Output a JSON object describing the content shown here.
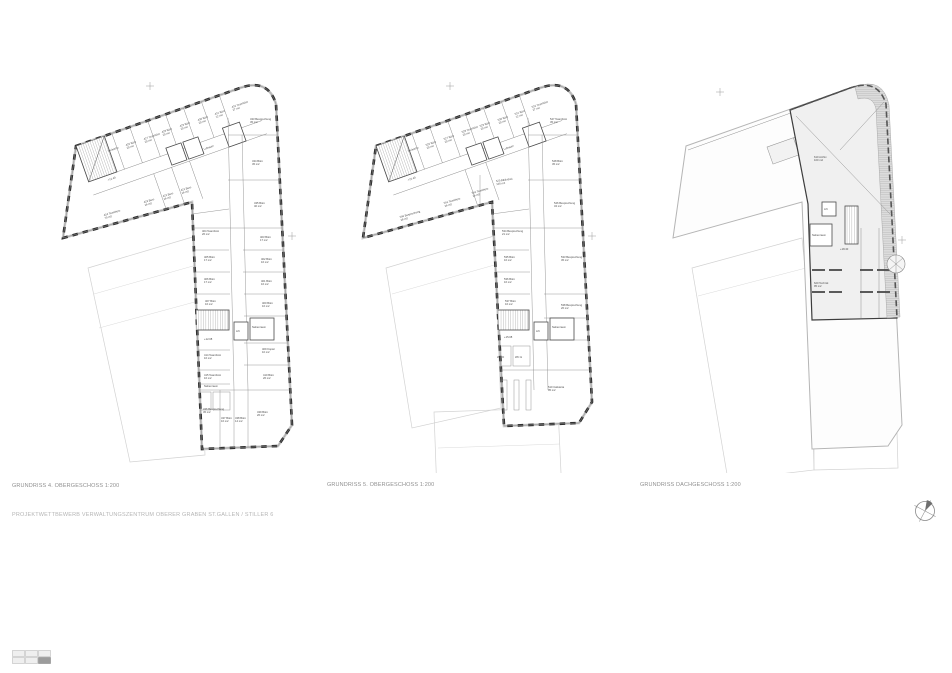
{
  "sheet": {
    "title": "PROJEKTWETTBEWERB VERWALTUNGSZENTRUM OBERER GRABEN ST.GALLEN / STILLER 6"
  },
  "colors": {
    "wall": "#303030",
    "partition": "#8c8c8c",
    "neighbor_outline": "#d2d2d2",
    "roof_hatch": "#9b9b9b",
    "caption": "#8f8f8f",
    "title": "#b5b5b5"
  },
  "footer": {
    "sheet_index": {
      "rows": 2,
      "cols": 3,
      "active_cell": "bottom-right"
    }
  },
  "north_symbol": "north-arrow",
  "plans": [
    {
      "caption": "GRUNDRISS 4. OBERGESCHOSS 1:200",
      "rooms": [
        {
          "name": "Teeküche",
          "area": ""
        },
        {
          "name": "426 Büro",
          "area": "20 m2"
        },
        {
          "name": "427 Teambüro",
          "area": "20 m2"
        },
        {
          "name": "428 Büro",
          "area": "20 m2"
        },
        {
          "name": "429 Büro",
          "area": "20 m2"
        },
        {
          "name": "430 Büro",
          "area": "20 m2"
        },
        {
          "name": "431 Büro",
          "area": "12 m2"
        },
        {
          "name": "432 Teambüro",
          "area": "27 m2"
        },
        {
          "name": "424 Teambüro",
          "area": "70 m2"
        },
        {
          "name": "423 Büro",
          "area": "16 m2"
        },
        {
          "name": "422 Büro",
          "area": "16 m2"
        },
        {
          "name": "421 Büro",
          "area": "16 m2"
        },
        {
          "name": "Luftraum",
          "area": ""
        },
        {
          "name": "+12.40",
          "area": ""
        },
        {
          "name": "433 Besprechung",
          "area": "45 m2"
        },
        {
          "name": "434 Büro",
          "area": "45 m2"
        },
        {
          "name": "435 Büro",
          "area": "40 m2"
        },
        {
          "name": "404 Teambüro",
          "area": "26 m2"
        },
        {
          "name": "405 Büro",
          "area": "17 m2"
        },
        {
          "name": "406 Büro",
          "area": "17 m2"
        },
        {
          "name": "407 Büro",
          "area": "16 m2"
        },
        {
          "name": "403 Büro",
          "area": "17 m2"
        },
        {
          "name": "402 Büro",
          "area": "16 m2"
        },
        {
          "name": "401 Büro",
          "area": "16 m2"
        },
        {
          "name": "400 Büro",
          "area": "16 m2"
        },
        {
          "name": "Nebenraum",
          "area": ""
        },
        {
          "name": "Lift",
          "area": ""
        },
        {
          "name": "+12.08",
          "area": ""
        },
        {
          "name": "414 Teambüro",
          "area": "16 m2"
        },
        {
          "name": "415 Teambüro",
          "area": "16 m2"
        },
        {
          "name": "Nebenraum",
          "area": ""
        },
        {
          "name": "409 Kopier",
          "area": "10 m2"
        },
        {
          "name": "410 Büro",
          "area": "26 m2"
        },
        {
          "name": "436 Besprechung",
          "area": "45 m2"
        },
        {
          "name": "437 Büro",
          "area": "16 m2"
        },
        {
          "name": "438 Büro",
          "area": "14 m2"
        },
        {
          "name": "439 Büro",
          "area": "26 m2"
        }
      ]
    },
    {
      "caption": "GRUNDRISS 5. OBERGESCHOSS 1:200",
      "rooms": [
        {
          "name": "Teeküche",
          "area": ""
        },
        {
          "name": "526 Büro",
          "area": "20 m2"
        },
        {
          "name": "527 Büro",
          "area": "20 m2"
        },
        {
          "name": "528 Teambüro",
          "area": "20 m2"
        },
        {
          "name": "529 Büro",
          "area": "20 m2"
        },
        {
          "name": "530 Büro",
          "area": "20 m2"
        },
        {
          "name": "531 Büro",
          "area": "12 m2"
        },
        {
          "name": "532 Teambüro",
          "area": "27 m2"
        },
        {
          "name": "540 Besprechung",
          "area": "28 m2"
        },
        {
          "name": "541 Teambüro",
          "area": "26 m2"
        },
        {
          "name": "542 Teambüro",
          "area": "16 m2"
        },
        {
          "name": "520 Bibliothek",
          "area": "100 m2"
        },
        {
          "name": "Luftraum",
          "area": ""
        },
        {
          "name": "+15.40",
          "area": ""
        },
        {
          "name": "547 Teambüro",
          "area": "45 m2"
        },
        {
          "name": "548 Büro",
          "area": "45 m2"
        },
        {
          "name": "546 Besprechung",
          "area": "34 m2"
        },
        {
          "name": "534 Besprechung",
          "area": "21 m2"
        },
        {
          "name": "535 Büro",
          "area": "16 m2"
        },
        {
          "name": "536 Büro",
          "area": "16 m2"
        },
        {
          "name": "537 Büro",
          "area": "16 m2"
        },
        {
          "name": "533 Besprechung",
          "area": "45 m2"
        },
        {
          "name": "Nebenraum",
          "area": ""
        },
        {
          "name": "Lift",
          "area": ""
        },
        {
          "name": "+15.08",
          "area": ""
        },
        {
          "name": "WC D",
          "area": ""
        },
        {
          "name": "WC H",
          "area": ""
        },
        {
          "name": "510 Cafeteria",
          "area": "95 m2"
        },
        {
          "name": "538 Besprechung",
          "area": "26 m2"
        }
      ]
    },
    {
      "caption": "GRUNDRISS DACHGESCHOSS 1:200",
      "rooms": [
        {
          "name": "610 Archiv",
          "area": "100 m2"
        },
        {
          "name": "Lift",
          "area": ""
        },
        {
          "name": "Nebenraum",
          "area": ""
        },
        {
          "name": "+18.40",
          "area": ""
        },
        {
          "name": "620 Technik",
          "area": "95 m2"
        }
      ]
    }
  ]
}
